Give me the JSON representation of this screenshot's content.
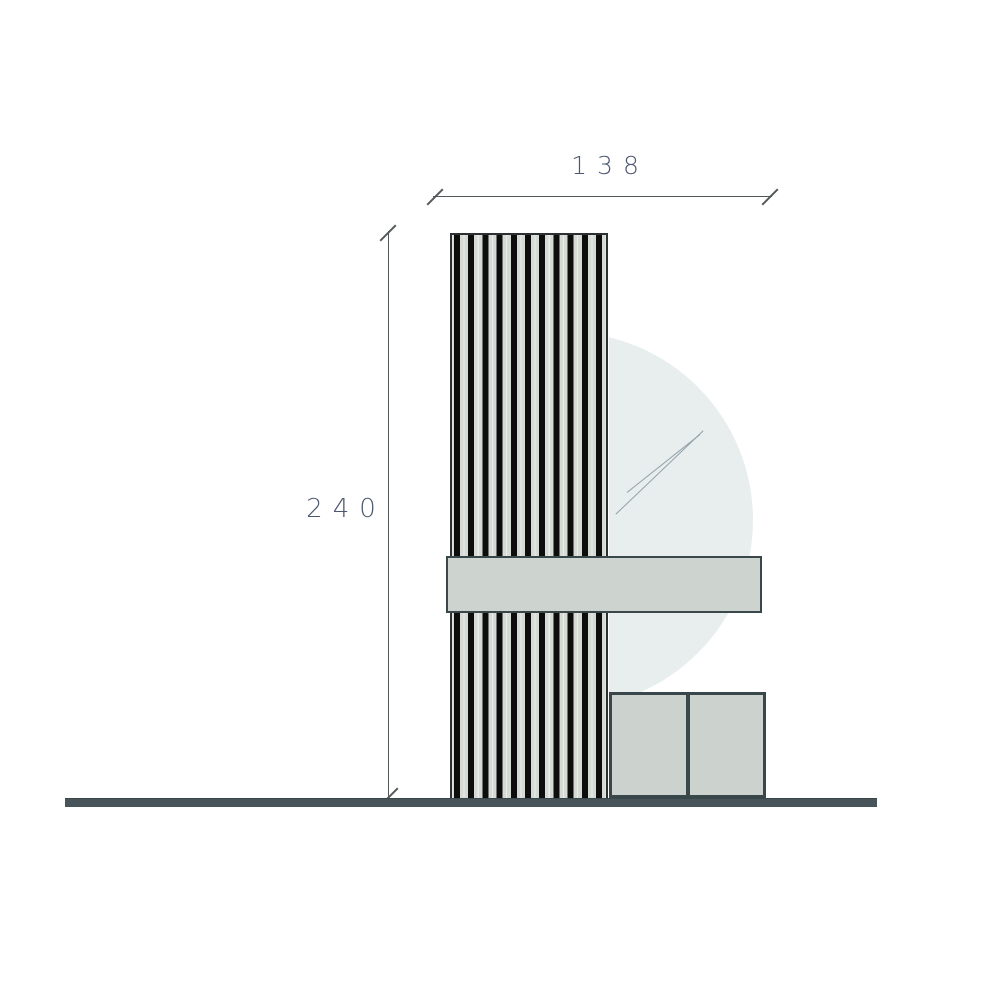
{
  "drawing": {
    "kind": "furniture elevation diagram",
    "dimensions": {
      "width_label": "138",
      "height_label": "240"
    }
  },
  "colors": {
    "panel-fill": "#d6dad5",
    "slat": "#0c0d0c",
    "shelf-fill": "#cdd4d0",
    "cabinet-fill": "#ccd3cf",
    "mirror-fill": "#e8edee",
    "glint": "#93a2a8",
    "floor": "#47545a",
    "outline": "#39464a",
    "outline-dark": "#2b3133",
    "dim-line": "#53595a",
    "dim-text": "#4d5870"
  }
}
